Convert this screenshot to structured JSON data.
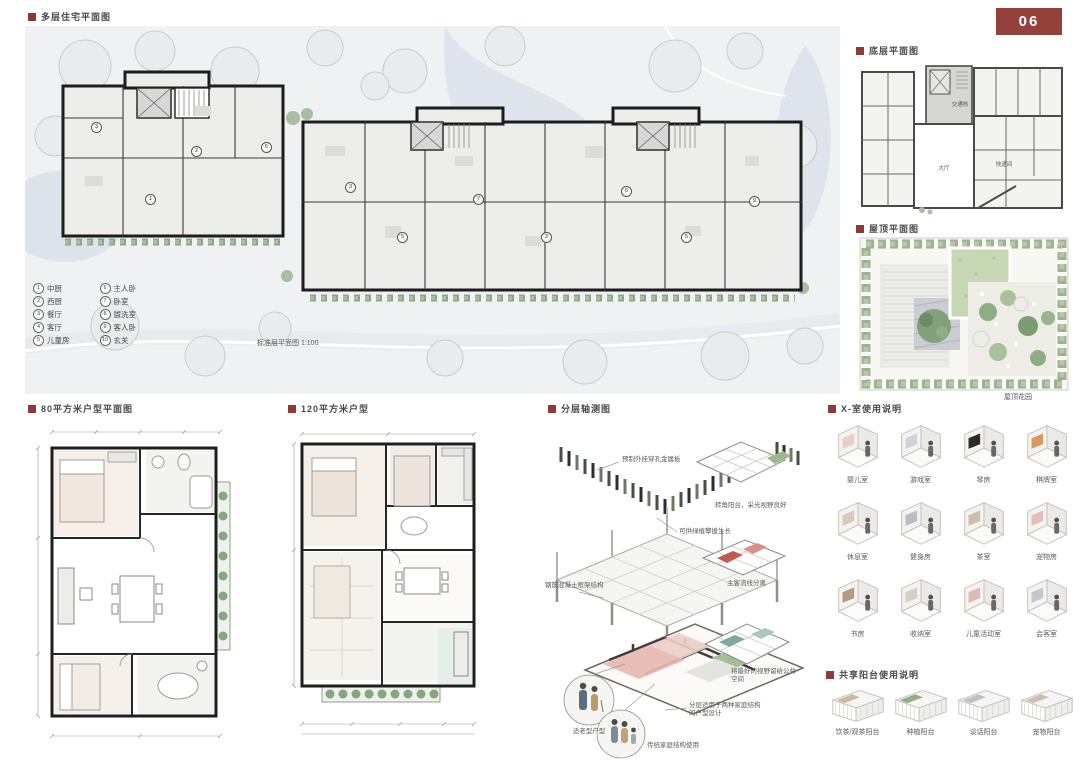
{
  "page": {
    "badge": "06"
  },
  "sections": {
    "site_plan": {
      "title": "多层住宅平面图",
      "caption": "标准层平面图 1:100",
      "legend": [
        {
          "num": "1",
          "label": "中厨"
        },
        {
          "num": "2",
          "label": "西厨"
        },
        {
          "num": "3",
          "label": "餐厅"
        },
        {
          "num": "4",
          "label": "客厅"
        },
        {
          "num": "5",
          "label": "儿童房"
        },
        {
          "num": "6",
          "label": "主人卧"
        },
        {
          "num": "7",
          "label": "卧室"
        },
        {
          "num": "8",
          "label": "盥洗室"
        },
        {
          "num": "9",
          "label": "客人卧"
        },
        {
          "num": "10",
          "label": "玄关"
        }
      ],
      "markers": [
        {
          "label": "3",
          "left": "66px",
          "top": "96px"
        },
        {
          "label": "1",
          "left": "120px",
          "top": "168px"
        },
        {
          "label": "2",
          "left": "166px",
          "top": "120px"
        },
        {
          "label": "5",
          "left": "236px",
          "top": "116px"
        },
        {
          "label": "3",
          "left": "320px",
          "top": "156px"
        },
        {
          "label": "5",
          "left": "372px",
          "top": "206px"
        },
        {
          "label": "7",
          "left": "448px",
          "top": "168px"
        },
        {
          "label": "3",
          "left": "516px",
          "top": "206px"
        },
        {
          "label": "6",
          "left": "596px",
          "top": "160px"
        },
        {
          "label": "5",
          "left": "656px",
          "top": "206px"
        },
        {
          "label": "9",
          "left": "724px",
          "top": "170px"
        }
      ]
    },
    "ground_floor": {
      "title": "底层平面图",
      "labels": {
        "core": "交通核",
        "hall": "大厅",
        "parcel": "快递间"
      }
    },
    "roof": {
      "title": "屋顶平面图",
      "caption": "屋顶花园"
    },
    "unit80": {
      "title": "80平方米户型平面图"
    },
    "unit120": {
      "title": "120平方米户型"
    },
    "axon": {
      "title": "分层轴测图",
      "notes": {
        "panel": "预制外挂穿孔金属板",
        "plants": "可供绿植攀援生长",
        "frame": "钢筋混凝土框架结构",
        "corner": "转角阳台，采光视野良好",
        "flow": "主客流线分离",
        "view": "将最好的视野留给公共空间",
        "split": "分层适用于两种家庭结构的户型设计",
        "elder": "适老型户型",
        "family": "传统家庭结构使用"
      }
    },
    "room_usage": {
      "title": "X-室使用说明",
      "items": [
        {
          "label": "婴儿室",
          "accent": "#e9cfc6"
        },
        {
          "label": "游戏室",
          "accent": "#cfd3d8"
        },
        {
          "label": "琴房",
          "accent": "#2b2b2b"
        },
        {
          "label": "棋牌室",
          "accent": "#d9995e"
        },
        {
          "label": "休息室",
          "accent": "#d9cbbb"
        },
        {
          "label": "健身房",
          "accent": "#b9bec5"
        },
        {
          "label": "茶室",
          "accent": "#cbbfa8"
        },
        {
          "label": "宠物房",
          "accent": "#e3c1ba"
        },
        {
          "label": "书房",
          "accent": "#b59a7e"
        },
        {
          "label": "收纳室",
          "accent": "#d6cfc4"
        },
        {
          "label": "儿童活动室",
          "accent": "#e0b9b4"
        },
        {
          "label": "会客室",
          "accent": "#c4c8cc"
        }
      ]
    },
    "balcony_usage": {
      "title": "共享阳台使用说明",
      "items": [
        {
          "label": "饮茶/观茶阳台",
          "accent": "#c9b9a2"
        },
        {
          "label": "种植阳台",
          "accent": "#8fae83"
        },
        {
          "label": "谈话阳台",
          "accent": "#b9c2c9"
        },
        {
          "label": "宠物阳台",
          "accent": "#cdbfae"
        }
      ]
    }
  },
  "colors": {
    "accent_red": "#8e3b35"
  }
}
